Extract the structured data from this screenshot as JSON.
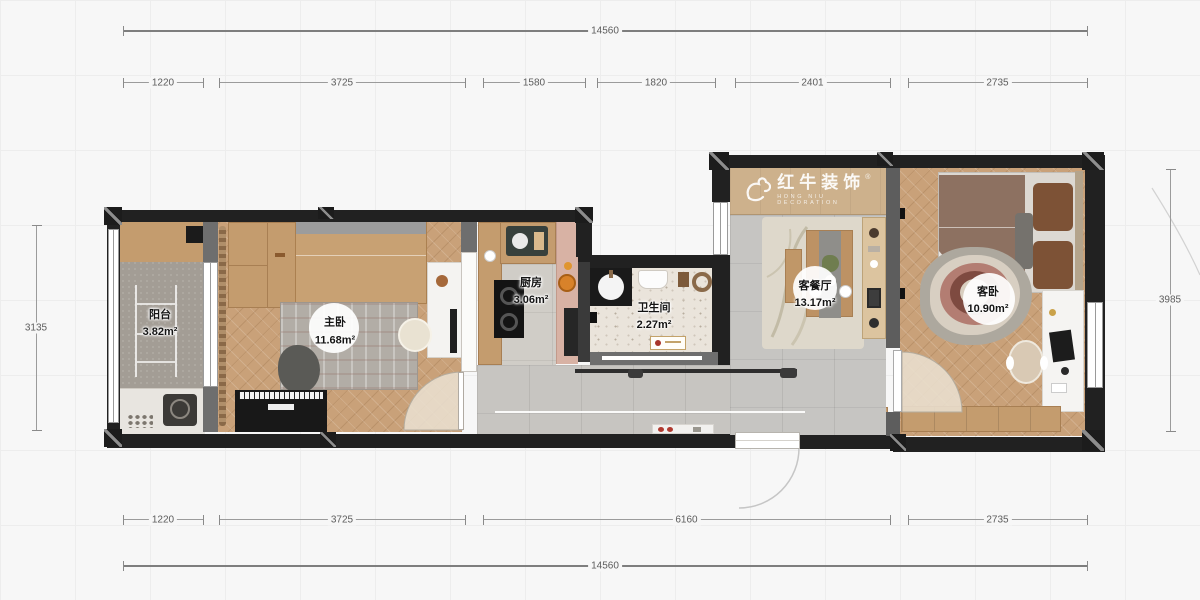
{
  "logo": {
    "cn": "红牛装饰",
    "en": "HONG NIU DECORATION",
    "reg": "®"
  },
  "rooms": [
    {
      "name": "阳台",
      "area": "3.82m²"
    },
    {
      "name": "主卧",
      "area": "11.68m²"
    },
    {
      "name": "厨房",
      "area": "3.06m²"
    },
    {
      "name": "卫生间",
      "area": "2.27m²"
    },
    {
      "name": "客餐厅",
      "area": "13.17m²"
    },
    {
      "name": "客卧",
      "area": "10.90m²"
    }
  ],
  "dimensions": {
    "top_total": {
      "label": "14560",
      "x1": 123,
      "x2": 1087,
      "y": 30,
      "thick": 2
    },
    "bottom_total": {
      "label": "14560",
      "x1": 123,
      "x2": 1087,
      "y": 565,
      "thick": 2
    },
    "top_segments": {
      "y": 82,
      "items": [
        {
          "label": "1220",
          "x1": 123,
          "x2": 203
        },
        {
          "label": "3725",
          "x1": 219,
          "x2": 465
        },
        {
          "label": "1580",
          "x1": 483,
          "x2": 585
        },
        {
          "label": "1820",
          "x1": 597,
          "x2": 715
        },
        {
          "label": "2401",
          "x1": 735,
          "x2": 890
        },
        {
          "label": "2735",
          "x1": 908,
          "x2": 1087
        }
      ]
    },
    "bottom_segments": {
      "y": 519,
      "items": [
        {
          "label": "1220",
          "x1": 123,
          "x2": 203
        },
        {
          "label": "3725",
          "x1": 219,
          "x2": 465
        },
        {
          "label": "6160",
          "x1": 483,
          "x2": 890
        },
        {
          "label": "2735",
          "x1": 908,
          "x2": 1087
        }
      ]
    },
    "left_dim": {
      "label": "3135",
      "x": 36,
      "y1": 225,
      "y2": 430
    },
    "right_dim": {
      "label": "3985",
      "x": 1170,
      "y1": 169,
      "y2": 431
    }
  },
  "colors": {
    "wall": "#212121",
    "wall_gray": "#6e6e6e",
    "cabinet_wood": "#c49c6e",
    "wood_floor": "#c9a179",
    "tile_floor": "#c7c5c1",
    "kitchen_pink": "#d8b2a4",
    "bed_brown": "#8d7161",
    "rug_red": "#7e4a40"
  }
}
